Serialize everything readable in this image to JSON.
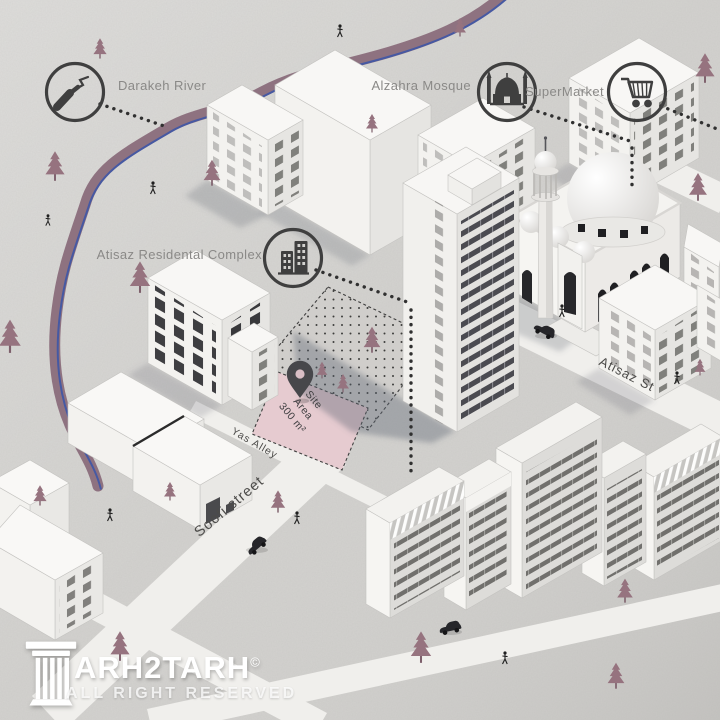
{
  "map": {
    "legend": {
      "river": {
        "label": "Darakeh River",
        "icon": "river-icon"
      },
      "mosque": {
        "label": "Alzahra Mosque",
        "icon": "mosque-icon"
      },
      "supermarket": {
        "label": "SuperMarket",
        "icon": "cart-icon"
      },
      "residential": {
        "label": "Atisaz Residental Complex",
        "icon": "buildings-icon"
      }
    },
    "site_label": {
      "line1": "Site",
      "line2": "Area",
      "line3": "300 m²"
    },
    "streets": {
      "atisaz": "Atisaz St",
      "yas": "Yas Alley",
      "soofi": "Soofi street"
    }
  },
  "logo": {
    "brand_full": "TARH2TARH",
    "brand_text": "ARH2TARH",
    "copyright": "©",
    "tagline": "ALL RIGHT RESERVED"
  },
  "colors": {
    "background": "#d3d2cf",
    "tree": "#96737f",
    "river_band": "#8a6d7b",
    "river_line": "#3e57a6",
    "site_area_fill": "#e6cbd0",
    "road": "#f0efec",
    "icon_dark": "#3f3f3f",
    "label_gray": "#8a8987",
    "street_label": "#4c4b49",
    "shadow": "#5d6370",
    "logo_white": "#ffffff"
  }
}
